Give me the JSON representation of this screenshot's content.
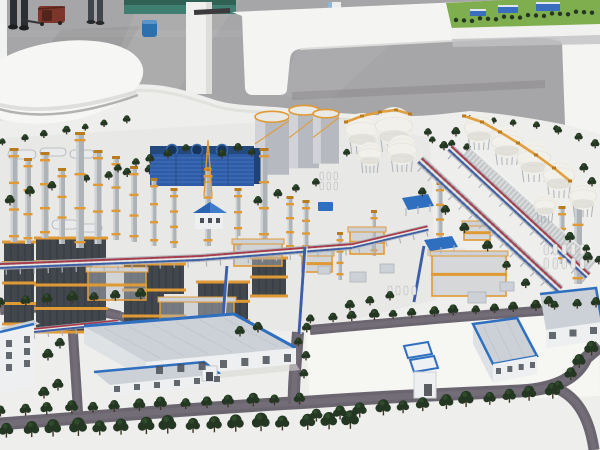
{
  "meta": {
    "caption": "Photograph of a large physical scale model of a petrochemical refinery complex displayed on a white podium in an exhibition hall, with white benches, a teal wall, visitors' legs and a bag on the grey floor"
  },
  "colors": {
    "floor": "#a6a5a7",
    "floor_light": "#bdbcbe",
    "floor_dark": "#8d8c8f",
    "wall_teal": "#3f7e71",
    "wall_teal_dark": "#2f6154",
    "white_hi": "#f0f1f1",
    "bench_white": "#f4f4f2",
    "bench_shade": "#dcdcda",
    "base_white": "#eeeeec",
    "base_shade": "#d8d8d6",
    "plant_tint": "#e3e3e1",
    "lot_tint": "#f6f6f4",
    "road": "#6b6570",
    "road_light": "#7b7580",
    "tree": "#243722",
    "tree_light": "#355430",
    "trunk": "#3f3526",
    "steel": "#42474e",
    "steel_dark": "#2e3238",
    "orange": "#e09a35",
    "orange_dark": "#b87c1e",
    "silver": "#aeb3b8",
    "silver_light": "#d6d9dc",
    "blue_bldg": "#2e5ca6",
    "blue_bldg_dark": "#1f4378",
    "blue_slat": "#4a77bf",
    "roof_blue": "#2f6fc0",
    "roof_gray": "#ccd1d7",
    "wall_white": "#edeff0",
    "side_wall": "#dfe2e5",
    "window": "#4a4f57",
    "sphere": "#f1f0ea",
    "sphere_shade": "#d9d7cf",
    "sphere_rib": "#e3e2da",
    "pipe_red": "#a93a4a",
    "pipe_blue": "#3c5ea8",
    "pipe_white": "#e8e8e6",
    "tank": "#b6bac0",
    "tank_light": "#d8dadd",
    "tank_top": "#e9eae6",
    "lattice": "#d8dadc",
    "lattice_line": "#bcc0c3",
    "green": "#7fae4e",
    "green_dark": "#5c8a3a",
    "bag": "#7c372a",
    "bag_dark": "#53241b",
    "person": "#2b2f34",
    "person2": "#41464c",
    "bin_blue": "#2e6fae"
  },
  "mini_model": {
    "buildings": [
      [
        470,
        9,
        16,
        7
      ],
      [
        498,
        5,
        20,
        8
      ],
      [
        536,
        2,
        24,
        9
      ]
    ],
    "tree_count": 18
  },
  "plant": {
    "tree_rows_back": [
      [
        4,
        145,
        126,
        123,
        7,
        7
      ],
      [
        88,
        182,
        148,
        174,
        4,
        8
      ],
      [
        258,
        170,
        300,
        162,
        3,
        7
      ],
      [
        472,
        121,
        556,
        131,
        5,
        6
      ],
      [
        560,
        134,
        596,
        148,
        3,
        8
      ],
      [
        434,
        143,
        468,
        151,
        3,
        7
      ],
      [
        336,
        152,
        346,
        156,
        2,
        7
      ]
    ],
    "tree_rows_front": [
      [
        8,
        437,
        352,
        428,
        16,
        15
      ],
      [
        2,
        416,
        298,
        404,
        14,
        11
      ],
      [
        318,
        421,
        552,
        398,
        12,
        13
      ],
      [
        560,
        392,
        590,
        355,
        4,
        12
      ],
      [
        312,
        323,
        596,
        307,
        15,
        9
      ],
      [
        2,
        307,
        140,
        299,
        7,
        10
      ],
      [
        424,
        196,
        548,
        306,
        7,
        9
      ],
      [
        588,
        252,
        598,
        264,
        2,
        8
      ],
      [
        300,
        346,
        306,
        332,
        2,
        9
      ]
    ],
    "trees_single": [
      [
        150,
        163,
        8
      ],
      [
        168,
        158,
        8
      ],
      [
        186,
        152,
        7
      ],
      [
        222,
        158,
        8
      ],
      [
        238,
        152,
        8
      ],
      [
        252,
        156,
        7
      ],
      [
        10,
        205,
        9
      ],
      [
        30,
        196,
        9
      ],
      [
        52,
        190,
        8
      ],
      [
        118,
        172,
        7
      ],
      [
        136,
        166,
        7
      ],
      [
        258,
        205,
        8
      ],
      [
        278,
        198,
        8
      ],
      [
        296,
        192,
        7
      ],
      [
        316,
        186,
        7
      ],
      [
        428,
        136,
        7
      ],
      [
        456,
        136,
        8
      ],
      [
        444,
        150,
        8
      ],
      [
        584,
        172,
        8
      ],
      [
        592,
        186,
        8
      ],
      [
        570,
        242,
        9
      ],
      [
        588,
        262,
        9
      ],
      [
        350,
        310,
        9
      ],
      [
        370,
        305,
        8
      ],
      [
        390,
        300,
        8
      ],
      [
        240,
        336,
        9
      ],
      [
        258,
        332,
        9
      ],
      [
        60,
        348,
        9
      ],
      [
        48,
        360,
        10
      ],
      [
        58,
        390,
        10
      ],
      [
        44,
        398,
        10
      ],
      [
        306,
        360,
        8
      ],
      [
        304,
        378,
        8
      ]
    ],
    "columns": [
      [
        14,
        150,
        92,
        7
      ],
      [
        28,
        160,
        84,
        6
      ],
      [
        45,
        154,
        84,
        7
      ],
      [
        62,
        170,
        74,
        6
      ],
      [
        80,
        134,
        114,
        8
      ],
      [
        98,
        152,
        92,
        7
      ],
      [
        116,
        158,
        82,
        6
      ],
      [
        134,
        168,
        74,
        6
      ],
      [
        154,
        180,
        66,
        5
      ],
      [
        174,
        190,
        58,
        5
      ],
      [
        208,
        170,
        76,
        6
      ],
      [
        238,
        190,
        60,
        5
      ],
      [
        264,
        150,
        90,
        7
      ],
      [
        290,
        198,
        54,
        5
      ],
      [
        306,
        202,
        50,
        5
      ],
      [
        340,
        234,
        46,
        4
      ],
      [
        374,
        212,
        44,
        4
      ],
      [
        440,
        184,
        56,
        5
      ],
      [
        578,
        192,
        92,
        8
      ],
      [
        562,
        208,
        56,
        5
      ]
    ],
    "frames": [
      [
        4,
        242,
        30,
        82,
        4
      ],
      [
        36,
        238,
        70,
        94,
        4
      ],
      [
        124,
        264,
        60,
        78,
        3
      ],
      [
        198,
        282,
        50,
        58,
        3
      ],
      [
        252,
        258,
        34,
        38,
        2
      ]
    ],
    "modules": [
      [
        88,
        270,
        58,
        30
      ],
      [
        160,
        300,
        74,
        44
      ],
      [
        234,
        242,
        48,
        24
      ],
      [
        350,
        230,
        34,
        24
      ],
      [
        432,
        254,
        74,
        42
      ],
      [
        464,
        224,
        26,
        16
      ],
      [
        302,
        254,
        30,
        18
      ]
    ],
    "cyl_tanks": [
      [
        272,
        112,
        34,
        58
      ],
      [
        304,
        106,
        30,
        58
      ],
      [
        326,
        110,
        26,
        50
      ]
    ],
    "capsules": [
      [
        8,
        150,
        28,
        9
      ],
      [
        40,
        148,
        26,
        8
      ],
      [
        70,
        150,
        24,
        8
      ],
      [
        52,
        220,
        26,
        9
      ],
      [
        80,
        224,
        22,
        8
      ]
    ],
    "spheres_center": [
      [
        362,
        130,
        17
      ],
      [
        394,
        126,
        19
      ],
      [
        402,
        150,
        15
      ],
      [
        370,
        154,
        12
      ]
    ],
    "spheres_row": [
      [
        479,
        128,
        15
      ],
      [
        507,
        142,
        16
      ],
      [
        534,
        158,
        17
      ],
      [
        559,
        175,
        16
      ],
      [
        583,
        196,
        14
      ],
      [
        545,
        205,
        11
      ]
    ],
    "stairs_center": "346,122 362,116 380,112 396,110 410,114",
    "stairs_row": "464,116 482,122 500,132 518,143 536,155 554,168 570,181",
    "racks": [
      [
        0,
        266,
        200,
        258,
        8
      ],
      [
        200,
        258,
        352,
        246,
        8
      ],
      [
        352,
        246,
        428,
        228,
        7
      ],
      [
        0,
        334,
        118,
        322,
        6
      ]
    ],
    "racks_diag": [
      [
        420,
        160,
        560,
        290,
        10
      ],
      [
        450,
        148,
        588,
        276,
        9
      ]
    ],
    "lattice_walls": [
      [
        466,
        152,
        592,
        266,
        13
      ]
    ],
    "vpipes": [
      [
        227,
        266,
        221,
        344
      ],
      [
        424,
        246,
        414,
        302
      ],
      [
        305,
        247,
        299,
        334
      ]
    ],
    "roads": [
      [
        "M0,424 C80,418 200,408 310,402 C380,397 470,393 520,391 C558,389 578,376 586,358 L600,346",
        13
      ],
      [
        "M298,332 C296,362 293,388 294,404",
        12
      ],
      [
        "M0,310 C40,306 82,306 120,316",
        10
      ],
      [
        "M72,318 C74,350 76,380 78,412",
        10
      ],
      [
        "M310,330 C400,322 500,313 598,307",
        10
      ],
      [
        "M560,390 C580,400 590,422 594,450",
        11
      ],
      [
        "M120,316 C150,325 166,334 188,340",
        9
      ]
    ],
    "equip_boxes": [
      [
        350,
        272,
        16,
        10
      ],
      [
        380,
        264,
        14,
        9
      ],
      [
        468,
        292,
        18,
        11
      ],
      [
        500,
        282,
        14,
        9
      ],
      [
        318,
        266,
        12,
        8
      ]
    ],
    "cyl_grids": [
      [
        544,
        244,
        5,
        2,
        4.5,
        11,
        9,
        14
      ],
      [
        388,
        286,
        4,
        1,
        4,
        9,
        8,
        12
      ],
      [
        320,
        172,
        3,
        2,
        3.5,
        8,
        7,
        10
      ]
    ],
    "window_rows": [
      [
        156,
        366,
        284,
        354,
        7,
        7,
        8
      ],
      [
        114,
        386,
        214,
        376,
        6,
        6,
        6
      ],
      [
        549,
        332,
        590,
        327,
        3,
        7,
        7
      ],
      [
        496,
        368,
        530,
        362,
        4,
        5,
        6
      ],
      [
        6,
        340,
        24,
        336,
        2,
        6,
        7
      ],
      [
        6,
        352,
        24,
        348,
        2,
        6,
        7
      ],
      [
        6,
        364,
        24,
        360,
        2,
        6,
        7
      ]
    ]
  }
}
